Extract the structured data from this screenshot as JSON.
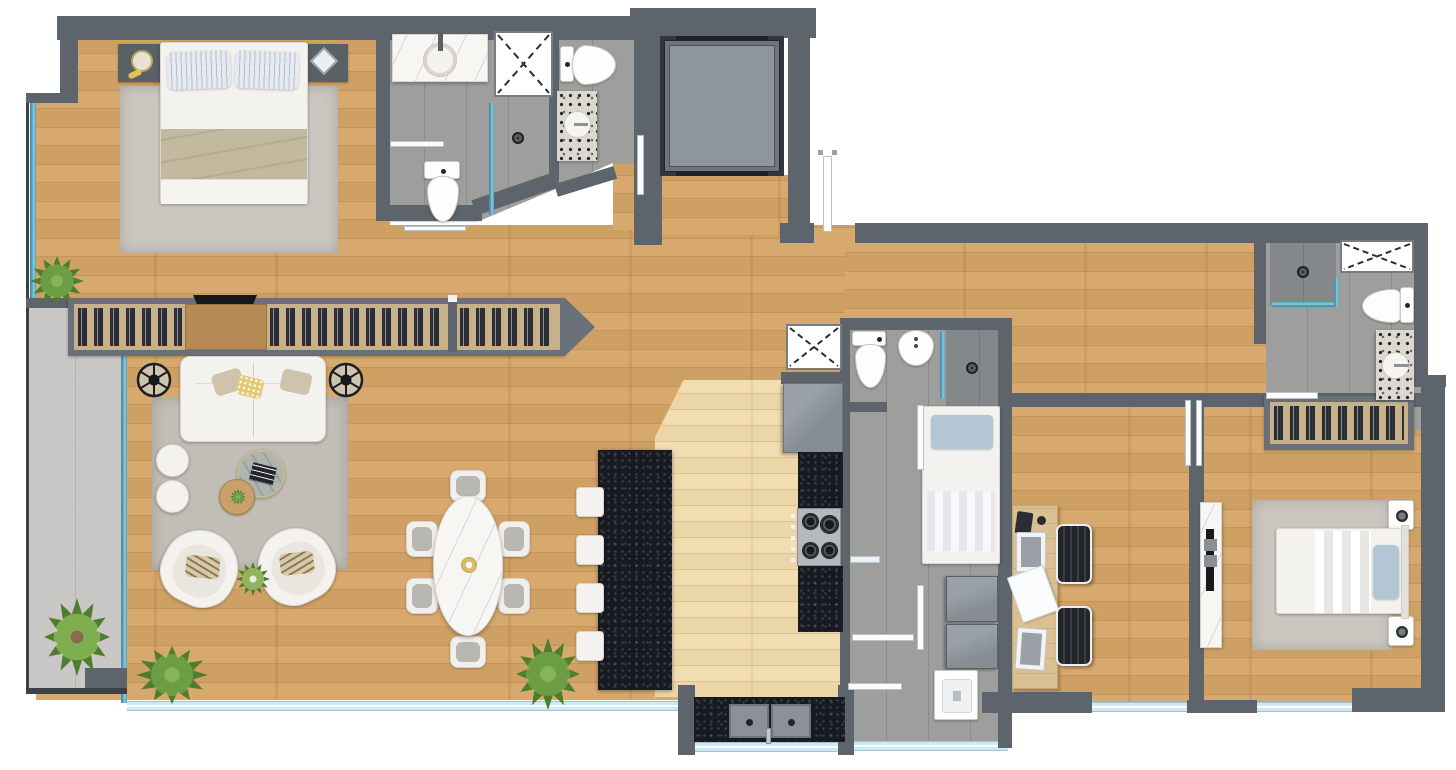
{
  "meta": {
    "type": "floor-plan-render",
    "view": "top-down",
    "description": "Photorealistic top-down rendering of an apartment floor plan with furnished rooms, no text labels"
  },
  "palette": {
    "wall": "#5d646b",
    "wall-dark": "#3d4147",
    "wood1": "#d8a96e",
    "wood1b": "#cfa064",
    "wood1-line": "#c3955c",
    "wood-pale": "#ecd6a8",
    "tile": "#9e9e9c",
    "tile-grout": "#8b8b89",
    "tile-dark": "#85888b",
    "balcony-tile": "#c9c8c6",
    "glass-teal": "#5aa3bf",
    "window-blue": "#cfe9f4",
    "granite": "#171a21",
    "terrazzo": "#dcd8d0",
    "marble": "#f7f6f3",
    "rug": "#c2beb6",
    "rug-bedroom": "#cbc7c0",
    "sofa-white": "#f4f2ee",
    "cushion": "#b9b7b2",
    "blanket-beige": "#c3b99f",
    "pillow-blue": "#b3c6d6",
    "chair-dark": "#212429",
    "desk-wood": "#d9bf93",
    "closet-liner": "#c7b08c",
    "closet-wood": "#b68a55",
    "hanger-dark": "#2b2e33",
    "plant-green": "#4f7d2f",
    "plant-light": "#6b9d44",
    "gold": "#c9a952",
    "elevator-cab": "#8f969e",
    "appliance-gray": "#8d9399",
    "stove-steel": "#b4b9bd"
  },
  "legend": {
    "rooms": [
      "master-bedroom",
      "ensuite-bathroom",
      "guest-bathroom",
      "elevator",
      "entry-hall",
      "living-room",
      "dining-area",
      "kitchen",
      "balcony",
      "service-wc",
      "service-bedroom",
      "laundry",
      "office",
      "second-bedroom",
      "second-bathroom",
      "hallway"
    ],
    "furniture": [
      "double-bed",
      "nightstand",
      "wardrobe-hangers",
      "dresser-tv",
      "sofa",
      "floor-lamp",
      "pouf",
      "coffee-table",
      "side-table",
      "armchair",
      "dining-table",
      "dining-chair",
      "kitchen-island",
      "bar-stool",
      "fridge",
      "stove",
      "counter",
      "double-sink",
      "vanity-sink",
      "toilet",
      "bidet",
      "shower",
      "skylight-panel",
      "single-bed",
      "washer",
      "dryer",
      "laundry-sink",
      "desk",
      "office-chair",
      "tv-console",
      "rug",
      "plant",
      "door-leaf",
      "window-glass"
    ]
  }
}
